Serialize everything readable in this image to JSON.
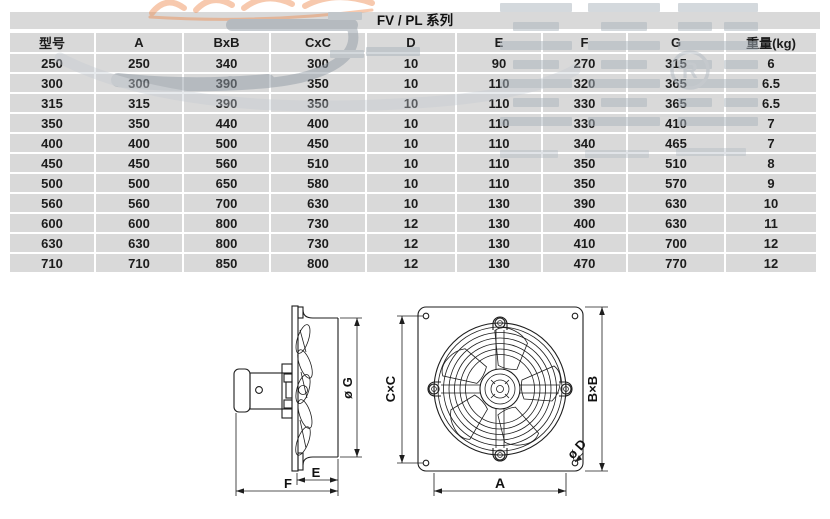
{
  "title": "FV / PL 系列",
  "table": {
    "headers": [
      "型号",
      "A",
      "BxB",
      "CxC",
      "D",
      "E",
      "F",
      "G",
      "重量(kg)"
    ],
    "rows": [
      [
        "250",
        "250",
        "340",
        "300",
        "10",
        "90",
        "270",
        "315",
        "6"
      ],
      [
        "300",
        "300",
        "390",
        "350",
        "10",
        "110",
        "320",
        "365",
        "6.5"
      ],
      [
        "315",
        "315",
        "390",
        "350",
        "10",
        "110",
        "330",
        "365",
        "6.5"
      ],
      [
        "350",
        "350",
        "440",
        "400",
        "10",
        "110",
        "330",
        "410",
        "7"
      ],
      [
        "400",
        "400",
        "500",
        "450",
        "10",
        "110",
        "340",
        "465",
        "7"
      ],
      [
        "450",
        "450",
        "560",
        "510",
        "10",
        "110",
        "350",
        "510",
        "8"
      ],
      [
        "500",
        "500",
        "650",
        "580",
        "10",
        "110",
        "350",
        "570",
        "9"
      ],
      [
        "560",
        "560",
        "700",
        "630",
        "10",
        "130",
        "390",
        "630",
        "10"
      ],
      [
        "600",
        "600",
        "800",
        "730",
        "12",
        "130",
        "400",
        "630",
        "11"
      ],
      [
        "630",
        "630",
        "800",
        "730",
        "12",
        "130",
        "410",
        "700",
        "12"
      ],
      [
        "710",
        "710",
        "850",
        "800",
        "12",
        "130",
        "470",
        "770",
        "12"
      ]
    ]
  },
  "watermark": {
    "registered_symbol": "®",
    "letter_r": "R"
  },
  "drawings": {
    "side_view": {
      "dim_g": "ø G",
      "dim_e": "E",
      "dim_f": "F"
    },
    "front_view": {
      "dim_cxc": "C×C",
      "dim_bxb": "B×B",
      "dim_a": "A",
      "dim_d": "ø D"
    }
  },
  "colors": {
    "cell_bg": "#d9d9d9",
    "line": "#1d1d1d",
    "watermark_gray": "#aab4bd",
    "watermark_dark": "#929ca6",
    "watermark_orange": "#ee8a4d"
  }
}
